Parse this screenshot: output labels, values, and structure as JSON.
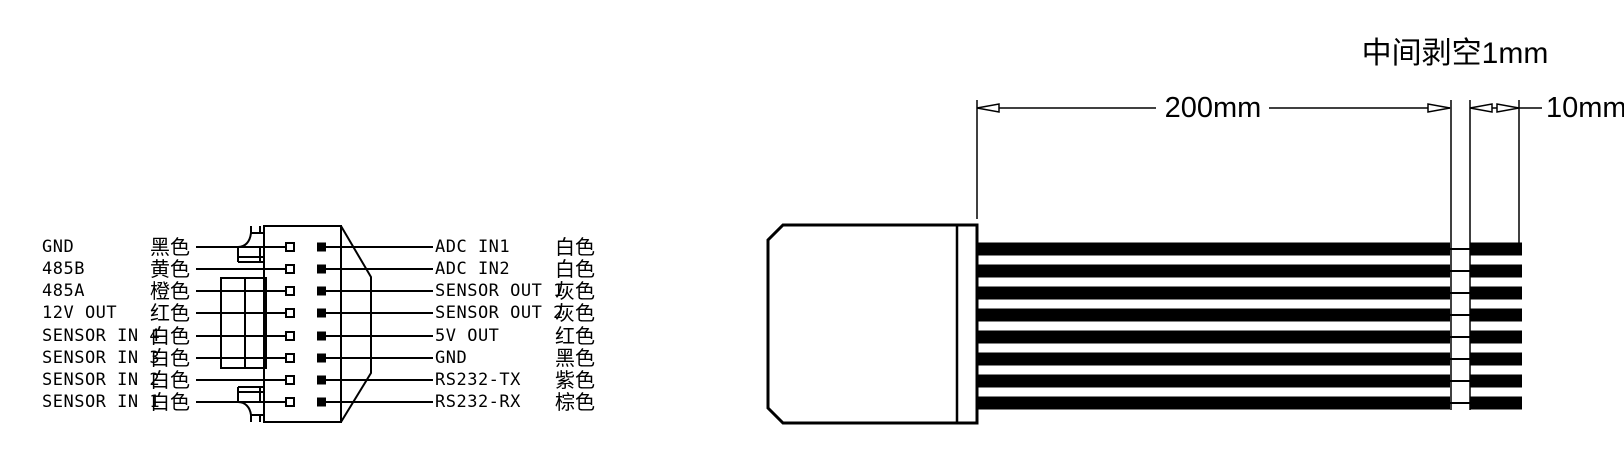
{
  "connector_pinout": {
    "left_pins": [
      {
        "signal": "GND",
        "color": "黑色"
      },
      {
        "signal": "485B",
        "color": "黄色"
      },
      {
        "signal": "485A",
        "color": "橙色"
      },
      {
        "signal": "12V OUT",
        "color": "红色"
      },
      {
        "signal": "SENSOR IN 4",
        "color": "白色"
      },
      {
        "signal": "SENSOR IN 3",
        "color": "白色"
      },
      {
        "signal": "SENSOR IN 2",
        "color": "白色"
      },
      {
        "signal": "SENSOR IN 1",
        "color": "白色"
      }
    ],
    "right_pins": [
      {
        "signal": "ADC IN1",
        "color": "白色"
      },
      {
        "signal": "ADC IN2",
        "color": "白色"
      },
      {
        "signal": "SENSOR OUT 1",
        "color": "灰色"
      },
      {
        "signal": "SENSOR OUT 2",
        "color": "灰色"
      },
      {
        "signal": "5V OUT",
        "color": "红色"
      },
      {
        "signal": "GND",
        "color": "黑色"
      },
      {
        "signal": "RS232-TX",
        "color": "紫色"
      },
      {
        "signal": "RS232-RX",
        "color": "棕色"
      }
    ]
  },
  "cable_drawing": {
    "length_label": "200mm",
    "tip_strip_label": "10mm",
    "mid_strip_note": "中间剥空1mm",
    "wire_count": 8
  },
  "colors": {
    "line": "#000000",
    "background": "#ffffff",
    "wire_fill": "#000000"
  }
}
